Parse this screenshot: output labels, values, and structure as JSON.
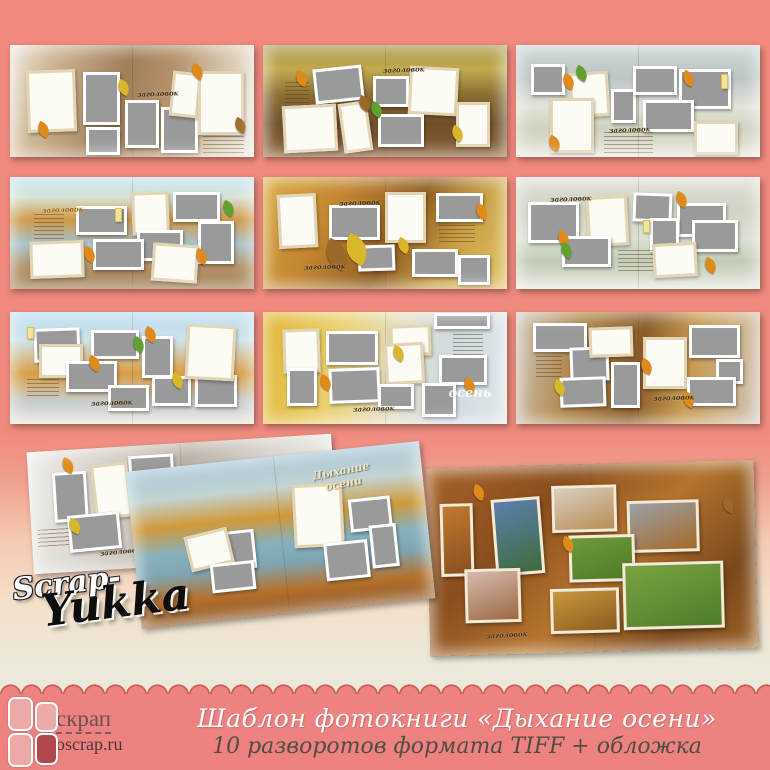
{
  "banner": {
    "title": "Шаблон фотокниги «Дыхание осени»",
    "subtitle": "10 разворотов формата TIFF + обложка",
    "logo_text": "скрап",
    "logo_url": "oscrap.ru"
  },
  "signature": {
    "line1": "Scrap-",
    "line2": "Yukka"
  },
  "labels": {
    "placeholder_caption": "заголовок",
    "cover_title": "Дыхание\nосени",
    "autumn_watermark": "осень"
  },
  "colors": {
    "background_salmon": "#f18a7d",
    "banner_pink": "#ee8281",
    "scallop_outline": "#c95b59",
    "placeholder_gray": "#9a9a9a",
    "logo_tile_light": "#eda9a6",
    "logo_tile_dark": "#b2484f"
  },
  "spreads": [
    {
      "name": "spread-1",
      "frames": [
        {
          "t": "w",
          "x": 7,
          "y": 22,
          "w": 20,
          "h": 55,
          "r": -2
        },
        {
          "t": "g",
          "x": 30,
          "y": 24,
          "w": 15,
          "h": 47
        },
        {
          "t": "g",
          "x": 31,
          "y": 73,
          "w": 14,
          "h": 25
        },
        {
          "t": "g",
          "x": 47,
          "y": 49,
          "w": 14,
          "h": 43
        },
        {
          "t": "g",
          "x": 62,
          "y": 55,
          "w": 15,
          "h": 41
        },
        {
          "t": "w",
          "x": 66,
          "y": 24,
          "w": 12,
          "h": 40,
          "r": 6
        },
        {
          "t": "w",
          "x": 77,
          "y": 23,
          "w": 19,
          "h": 57
        },
        {
          "t": "j",
          "x": 79,
          "y": 81,
          "w": 17,
          "h": 15
        }
      ],
      "leaves": [
        {
          "c": "o",
          "x": 11,
          "y": 70
        },
        {
          "c": "o",
          "x": 74,
          "y": 18
        },
        {
          "c": "b",
          "x": 92,
          "y": 66
        },
        {
          "c": "y",
          "x": 44,
          "y": 32
        }
      ],
      "captions": [
        {
          "x": 52,
          "y": 39
        }
      ]
    },
    {
      "name": "spread-2",
      "frames": [
        {
          "t": "g",
          "x": 21,
          "y": 20,
          "w": 20,
          "h": 31,
          "r": -6
        },
        {
          "t": "g",
          "x": 45,
          "y": 28,
          "w": 15,
          "h": 27
        },
        {
          "t": "w",
          "x": 60,
          "y": 20,
          "w": 20,
          "h": 43,
          "r": 3
        },
        {
          "t": "w",
          "x": 79,
          "y": 51,
          "w": 14,
          "h": 40
        },
        {
          "t": "w",
          "x": 8,
          "y": 54,
          "w": 22,
          "h": 42,
          "r": -3
        },
        {
          "t": "w",
          "x": 32,
          "y": 51,
          "w": 12,
          "h": 45,
          "r": -8
        },
        {
          "t": "g",
          "x": 47,
          "y": 62,
          "w": 19,
          "h": 29
        },
        {
          "t": "j",
          "x": 9,
          "y": 33,
          "w": 10,
          "h": 21
        }
      ],
      "leaves": [
        {
          "c": "o",
          "x": 13,
          "y": 24
        },
        {
          "c": "b",
          "x": 39,
          "y": 46
        },
        {
          "c": "g",
          "x": 44,
          "y": 52
        },
        {
          "c": "y",
          "x": 77,
          "y": 73
        }
      ],
      "captions": [
        {
          "x": 49,
          "y": 18
        }
      ]
    },
    {
      "name": "spread-3",
      "frames": [
        {
          "t": "g",
          "x": 6,
          "y": 17,
          "w": 14,
          "h": 28
        },
        {
          "t": "w",
          "x": 22,
          "y": 24,
          "w": 16,
          "h": 40,
          "r": -4
        },
        {
          "t": "g",
          "x": 39,
          "y": 39,
          "w": 10,
          "h": 31
        },
        {
          "t": "g",
          "x": 48,
          "y": 19,
          "w": 18,
          "h": 26
        },
        {
          "t": "g",
          "x": 67,
          "y": 21,
          "w": 21,
          "h": 36
        },
        {
          "t": "g",
          "x": 52,
          "y": 49,
          "w": 21,
          "h": 29
        },
        {
          "t": "w",
          "x": 14,
          "y": 47,
          "w": 18,
          "h": 49
        },
        {
          "t": "w",
          "x": 73,
          "y": 68,
          "w": 18,
          "h": 30
        },
        {
          "t": "j",
          "x": 36,
          "y": 78,
          "w": 20,
          "h": 18
        },
        {
          "t": "y",
          "x": 84,
          "y": 26,
          "w": 3,
          "h": 13
        }
      ],
      "leaves": [
        {
          "c": "o",
          "x": 19,
          "y": 27
        },
        {
          "c": "o",
          "x": 68,
          "y": 24
        },
        {
          "c": "o",
          "x": 13,
          "y": 82
        },
        {
          "c": "g",
          "x": 24,
          "y": 20
        }
      ],
      "captions": [
        {
          "x": 38,
          "y": 71
        }
      ]
    },
    {
      "name": "spread-4",
      "frames": [
        {
          "t": "g",
          "x": 27,
          "y": 26,
          "w": 21,
          "h": 26
        },
        {
          "t": "w",
          "x": 50,
          "y": 13,
          "w": 15,
          "h": 38,
          "r": -2
        },
        {
          "t": "g",
          "x": 67,
          "y": 13,
          "w": 19,
          "h": 27
        },
        {
          "t": "g",
          "x": 52,
          "y": 47,
          "w": 19,
          "h": 28
        },
        {
          "t": "g",
          "x": 77,
          "y": 39,
          "w": 15,
          "h": 39
        },
        {
          "t": "g",
          "x": 34,
          "y": 55,
          "w": 21,
          "h": 28
        },
        {
          "t": "w",
          "x": 8,
          "y": 57,
          "w": 22,
          "h": 33,
          "r": -2
        },
        {
          "t": "w",
          "x": 58,
          "y": 60,
          "w": 19,
          "h": 34,
          "r": 4
        },
        {
          "t": "j",
          "x": 10,
          "y": 33,
          "w": 12,
          "h": 24
        },
        {
          "t": "y",
          "x": 43,
          "y": 28,
          "w": 3,
          "h": 12
        }
      ],
      "leaves": [
        {
          "c": "o",
          "x": 30,
          "y": 63
        },
        {
          "c": "o",
          "x": 76,
          "y": 65
        },
        {
          "c": "g",
          "x": 87,
          "y": 22
        }
      ],
      "captions": [
        {
          "x": 13,
          "y": 25,
          "cls": "orange"
        }
      ]
    },
    {
      "name": "spread-5",
      "frames": [
        {
          "t": "w",
          "x": 6,
          "y": 15,
          "w": 16,
          "h": 48,
          "r": -3
        },
        {
          "t": "g",
          "x": 27,
          "y": 25,
          "w": 21,
          "h": 31
        },
        {
          "t": "w",
          "x": 50,
          "y": 13,
          "w": 17,
          "h": 46
        },
        {
          "t": "g",
          "x": 71,
          "y": 14,
          "w": 19,
          "h": 26
        },
        {
          "t": "g",
          "x": 39,
          "y": 61,
          "w": 15,
          "h": 23,
          "r": -2
        },
        {
          "t": "g",
          "x": 61,
          "y": 64,
          "w": 19,
          "h": 25
        },
        {
          "t": "g",
          "x": 80,
          "y": 70,
          "w": 13,
          "h": 26
        },
        {
          "t": "j",
          "x": 72,
          "y": 43,
          "w": 15,
          "h": 18
        }
      ],
      "leaves": [
        {
          "c": "b",
          "x": 25,
          "y": 58,
          "big": true
        },
        {
          "c": "y",
          "x": 33,
          "y": 54,
          "big": true
        },
        {
          "c": "o",
          "x": 87,
          "y": 25
        },
        {
          "c": "y",
          "x": 55,
          "y": 55
        }
      ],
      "captions": [
        {
          "x": 31,
          "y": 19
        },
        {
          "x": 17,
          "y": 76
        }
      ]
    },
    {
      "name": "spread-6",
      "frames": [
        {
          "t": "g",
          "x": 5,
          "y": 22,
          "w": 21,
          "h": 37
        },
        {
          "t": "w",
          "x": 29,
          "y": 17,
          "w": 17,
          "h": 45,
          "r": -3
        },
        {
          "t": "g",
          "x": 48,
          "y": 14,
          "w": 16,
          "h": 26,
          "r": 2
        },
        {
          "t": "g",
          "x": 66,
          "y": 23,
          "w": 20,
          "h": 31
        },
        {
          "t": "g",
          "x": 55,
          "y": 37,
          "w": 12,
          "h": 30
        },
        {
          "t": "g",
          "x": 72,
          "y": 38,
          "w": 19,
          "h": 29
        },
        {
          "t": "g",
          "x": 19,
          "y": 53,
          "w": 20,
          "h": 27
        },
        {
          "t": "w",
          "x": 56,
          "y": 59,
          "w": 18,
          "h": 30,
          "r": -3
        },
        {
          "t": "j",
          "x": 42,
          "y": 65,
          "w": 14,
          "h": 19
        },
        {
          "t": "y",
          "x": 52,
          "y": 38,
          "w": 3,
          "h": 12
        }
      ],
      "leaves": [
        {
          "c": "o",
          "x": 17,
          "y": 49
        },
        {
          "c": "g",
          "x": 18,
          "y": 60
        },
        {
          "c": "o",
          "x": 65,
          "y": 14
        },
        {
          "c": "o",
          "x": 77,
          "y": 73
        }
      ],
      "captions": [
        {
          "x": 14,
          "y": 15
        }
      ]
    },
    {
      "name": "spread-7",
      "frames": [
        {
          "t": "g",
          "x": 10,
          "y": 14,
          "w": 19,
          "h": 30,
          "r": -2
        },
        {
          "t": "w",
          "x": 12,
          "y": 29,
          "w": 18,
          "h": 30
        },
        {
          "t": "g",
          "x": 33,
          "y": 16,
          "w": 20,
          "h": 26
        },
        {
          "t": "g",
          "x": 54,
          "y": 21,
          "w": 13,
          "h": 38
        },
        {
          "t": "g",
          "x": 23,
          "y": 44,
          "w": 21,
          "h": 27
        },
        {
          "t": "g",
          "x": 40,
          "y": 65,
          "w": 17,
          "h": 23
        },
        {
          "t": "g",
          "x": 58,
          "y": 57,
          "w": 16,
          "h": 27
        },
        {
          "t": "g",
          "x": 76,
          "y": 56,
          "w": 17,
          "h": 29
        },
        {
          "t": "w",
          "x": 72,
          "y": 12,
          "w": 20,
          "h": 49,
          "r": 3
        },
        {
          "t": "j",
          "x": 7,
          "y": 60,
          "w": 13,
          "h": 17
        },
        {
          "t": "y",
          "x": 7,
          "y": 13,
          "w": 3,
          "h": 11
        }
      ],
      "leaves": [
        {
          "c": "o",
          "x": 32,
          "y": 40
        },
        {
          "c": "o",
          "x": 55,
          "y": 14
        },
        {
          "c": "g",
          "x": 50,
          "y": 23
        },
        {
          "c": "y",
          "x": 66,
          "y": 55
        }
      ],
      "captions": [
        {
          "x": 33,
          "y": 77
        }
      ]
    },
    {
      "name": "spread-8",
      "frames": [
        {
          "t": "w",
          "x": 8,
          "y": 15,
          "w": 15,
          "h": 39,
          "r": -2
        },
        {
          "t": "g",
          "x": 26,
          "y": 17,
          "w": 21,
          "h": 30
        },
        {
          "t": "w",
          "x": 52,
          "y": 12,
          "w": 17,
          "h": 28,
          "r": -2
        },
        {
          "t": "g",
          "x": 70,
          "y": 1,
          "w": 23,
          "h": 14
        },
        {
          "t": "w",
          "x": 50,
          "y": 28,
          "w": 16,
          "h": 37,
          "r": -3
        },
        {
          "t": "g",
          "x": 72,
          "y": 38,
          "w": 20,
          "h": 27
        },
        {
          "t": "g",
          "x": 10,
          "y": 50,
          "w": 12,
          "h": 34
        },
        {
          "t": "g",
          "x": 27,
          "y": 50,
          "w": 21,
          "h": 31,
          "r": -2
        },
        {
          "t": "g",
          "x": 47,
          "y": 64,
          "w": 15,
          "h": 23
        },
        {
          "t": "g",
          "x": 65,
          "y": 63,
          "w": 14,
          "h": 31
        },
        {
          "t": "j",
          "x": 78,
          "y": 20,
          "w": 12,
          "h": 18
        }
      ],
      "leaves": [
        {
          "c": "o",
          "x": 23,
          "y": 57
        },
        {
          "c": "o",
          "x": 82,
          "y": 60
        },
        {
          "c": "y",
          "x": 53,
          "y": 31
        }
      ],
      "captions": [
        {
          "x": 37,
          "y": 82
        },
        {
          "x": 76,
          "y": 66,
          "cls": "watermark",
          "key": "autumn"
        }
      ]
    },
    {
      "name": "spread-9",
      "frames": [
        {
          "t": "g",
          "x": 7,
          "y": 10,
          "w": 22,
          "h": 26
        },
        {
          "t": "g",
          "x": 22,
          "y": 31,
          "w": 16,
          "h": 30,
          "r": -2
        },
        {
          "t": "w",
          "x": 30,
          "y": 13,
          "w": 18,
          "h": 27,
          "r": -2
        },
        {
          "t": "w",
          "x": 52,
          "y": 22,
          "w": 18,
          "h": 47
        },
        {
          "t": "g",
          "x": 71,
          "y": 12,
          "w": 21,
          "h": 29
        },
        {
          "t": "g",
          "x": 82,
          "y": 42,
          "w": 11,
          "h": 22
        },
        {
          "t": "g",
          "x": 39,
          "y": 45,
          "w": 12,
          "h": 41
        },
        {
          "t": "g",
          "x": 18,
          "y": 58,
          "w": 19,
          "h": 27,
          "r": -2
        },
        {
          "t": "g",
          "x": 70,
          "y": 58,
          "w": 20,
          "h": 26
        },
        {
          "t": "j",
          "x": 8,
          "y": 39,
          "w": 11,
          "h": 19
        }
      ],
      "leaves": [
        {
          "c": "o",
          "x": 51,
          "y": 43
        },
        {
          "c": "o",
          "x": 68,
          "y": 72
        },
        {
          "c": "y",
          "x": 15,
          "y": 62
        }
      ],
      "captions": [
        {
          "x": 56,
          "y": 72
        }
      ]
    },
    {
      "name": "spread-10",
      "frames": [
        {
          "t": "g",
          "x": 8,
          "y": 18,
          "w": 11,
          "h": 41
        },
        {
          "t": "w",
          "x": 21,
          "y": 13,
          "w": 12,
          "h": 45,
          "r": -3
        },
        {
          "t": "g",
          "x": 33,
          "y": 8,
          "w": 15,
          "h": 26
        },
        {
          "t": "g",
          "x": 12,
          "y": 53,
          "w": 17,
          "h": 30,
          "r": -2
        },
        {
          "t": "g",
          "x": 49,
          "y": 19,
          "w": 15,
          "h": 25
        },
        {
          "t": "g",
          "x": 60,
          "y": 32,
          "w": 14,
          "h": 28
        },
        {
          "t": "j",
          "x": 2,
          "y": 64,
          "w": 10,
          "h": 15
        }
      ],
      "leaves": [
        {
          "c": "o",
          "x": 11,
          "y": 7
        },
        {
          "c": "y",
          "x": 12,
          "y": 57
        }
      ],
      "captions": [
        {
          "x": 22,
          "y": 82
        }
      ]
    },
    {
      "name": "cover",
      "frames": [
        {
          "t": "w",
          "x": 55,
          "y": 20,
          "w": 17,
          "h": 40,
          "r": 3
        },
        {
          "t": "g",
          "x": 74,
          "y": 32,
          "w": 14,
          "h": 21
        },
        {
          "t": "g",
          "x": 29,
          "y": 44,
          "w": 12,
          "h": 25
        },
        {
          "t": "w",
          "x": 18,
          "y": 43,
          "w": 15,
          "h": 23,
          "r": -8
        },
        {
          "t": "g",
          "x": 25,
          "y": 64,
          "w": 15,
          "h": 18
        },
        {
          "t": "g",
          "x": 64,
          "y": 58,
          "w": 15,
          "h": 24
        },
        {
          "t": "g",
          "x": 80,
          "y": 50,
          "w": 9,
          "h": 27
        }
      ],
      "leaves": [],
      "captions": [
        {
          "x": 63,
          "y": 10,
          "cls": "cover-title",
          "key": "cover"
        }
      ]
    },
    {
      "name": "example",
      "frames": [
        {
          "t": "p",
          "x": 4,
          "y": 19,
          "w": 10,
          "h": 39,
          "pal": [
            "#c07a30",
            "#8a4f1e"
          ]
        },
        {
          "t": "p",
          "x": 20,
          "y": 17,
          "w": 15,
          "h": 41,
          "r": -3,
          "pal": [
            "#5c7fae",
            "#3e6b3a"
          ]
        },
        {
          "t": "p",
          "x": 38,
          "y": 11,
          "w": 20,
          "h": 25,
          "pal": [
            "#d9cfc0",
            "#b98d55"
          ]
        },
        {
          "t": "p",
          "x": 61,
          "y": 20,
          "w": 22,
          "h": 28,
          "pal": [
            "#9aa0a8",
            "#a56a28"
          ]
        },
        {
          "t": "p",
          "x": 43,
          "y": 38,
          "w": 20,
          "h": 25,
          "pal": [
            "#6f9b3a",
            "#4f7a28"
          ]
        },
        {
          "t": "p",
          "x": 11,
          "y": 54,
          "w": 17,
          "h": 29,
          "pal": [
            "#d8b9b0",
            "#9a6a40"
          ]
        },
        {
          "t": "p",
          "x": 37,
          "y": 66,
          "w": 21,
          "h": 24,
          "pal": [
            "#c9973f",
            "#8a5c20"
          ]
        },
        {
          "t": "p",
          "x": 59,
          "y": 53,
          "w": 31,
          "h": 36,
          "pal": [
            "#7aa341",
            "#4e7c2a"
          ]
        }
      ],
      "leaves": [
        {
          "c": "o",
          "x": 41,
          "y": 39
        },
        {
          "c": "o",
          "x": 14,
          "y": 10
        },
        {
          "c": "b",
          "x": 90,
          "y": 20
        }
      ],
      "captions": [
        {
          "x": 17,
          "y": 87
        }
      ]
    }
  ]
}
